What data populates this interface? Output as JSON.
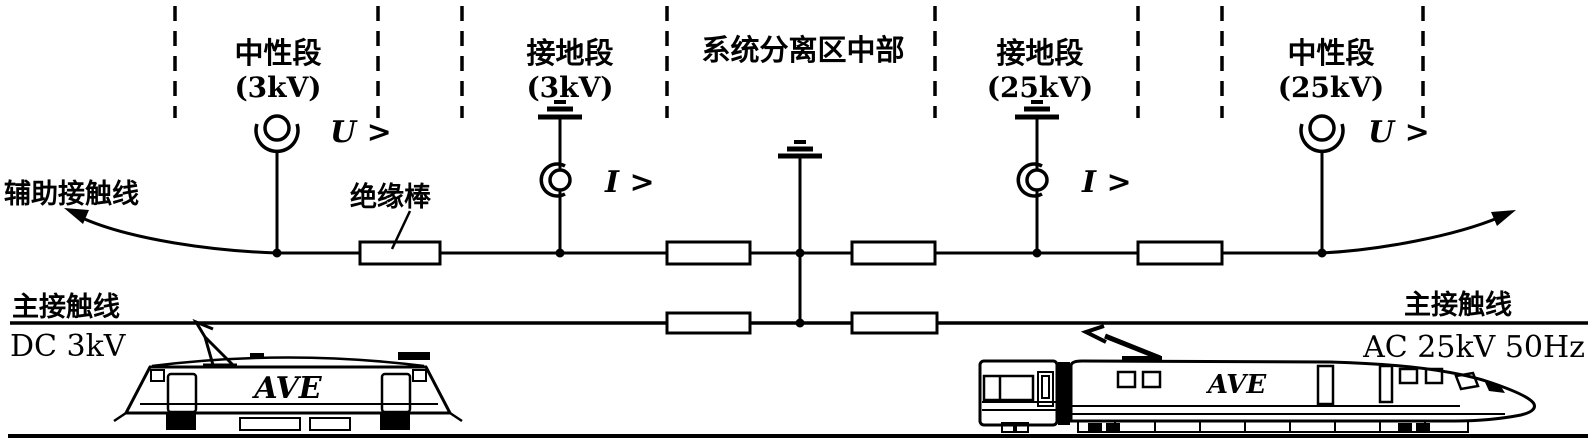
{
  "diagram": {
    "sections": [
      {
        "name": "中性段",
        "voltage": "(3kV)"
      },
      {
        "name": "接地段",
        "voltage": "(3kV)"
      },
      {
        "name": "系统分离区中部",
        "voltage": ""
      },
      {
        "name": "接地段",
        "voltage": "(25kV)"
      },
      {
        "name": "中性段",
        "voltage": "(25kV)"
      }
    ],
    "relays": {
      "u_left": "U >",
      "i_left": "I >",
      "i_right": "I >",
      "u_right": "U >"
    },
    "wires": {
      "auxiliary": "辅助接触线",
      "insulator_rod": "绝缘棒",
      "main_left": "主接触线",
      "main_right": "主接触线"
    },
    "systems": {
      "left": "DC 3kV",
      "right": "AC 25kV 50Hz"
    },
    "trains": {
      "left": "AVE",
      "right": "AVE"
    },
    "colors": {
      "ink": "#000000",
      "background": "#ffffff"
    }
  }
}
